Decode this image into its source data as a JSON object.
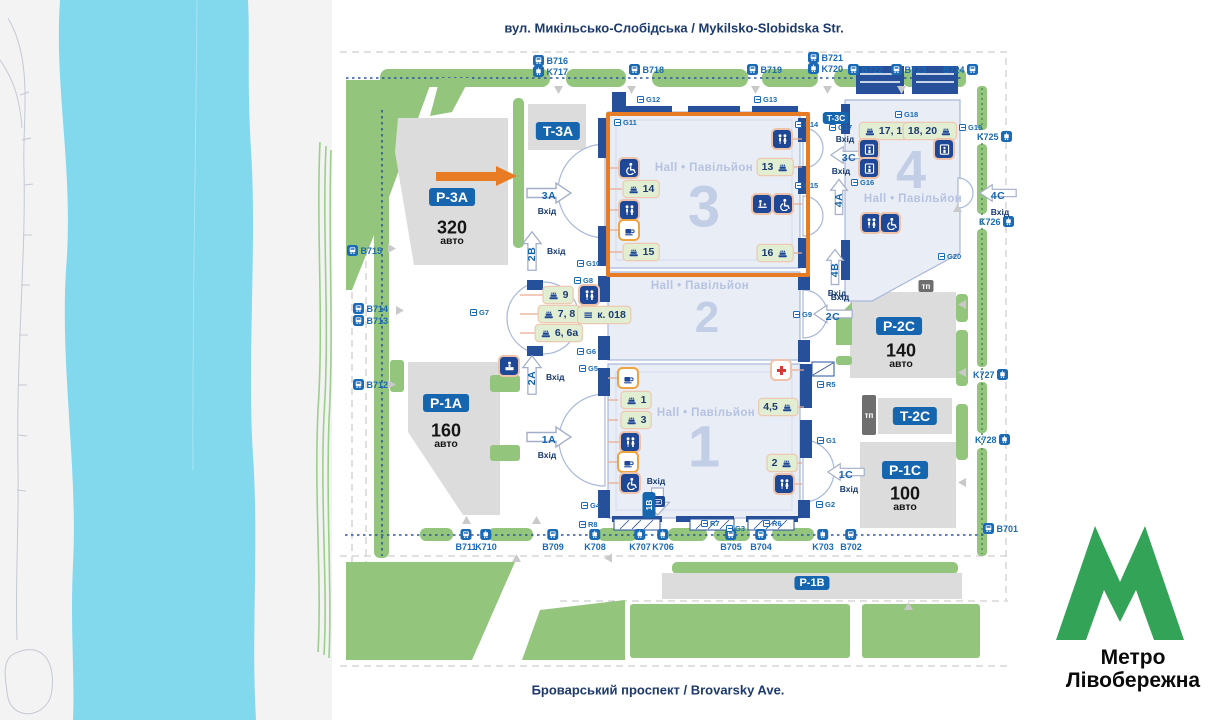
{
  "streets": {
    "top": "вул. Микільсько-Слобідська / Mykilsko-Slobidska Str.",
    "bottom": "Броварський проспект / Brovarsky Ave."
  },
  "metro": {
    "line1": "Метро",
    "line2": "Лівобережна"
  },
  "labels": {
    "entrance": "Вхід",
    "hall": "Hall • Павільйон",
    "cars": "авто",
    "tp": "тп"
  },
  "halls": {
    "h1": "1",
    "h2": "2",
    "h3": "3",
    "h4": "4"
  },
  "parking": {
    "p3a": {
      "code": "P-3A",
      "cars": "320"
    },
    "p1a": {
      "code": "P-1A",
      "cars": "160"
    },
    "p2c": {
      "code": "P-2C",
      "cars": "140"
    },
    "p1c": {
      "code": "P-1C",
      "cars": "100"
    },
    "p1b": {
      "code": "P-1B"
    },
    "t3a": "T-3A",
    "t2c": "T-2C",
    "t3c": "T-3C"
  },
  "entrances": {
    "e3a": "3A",
    "e2b": "2B",
    "e2a": "2A",
    "e1a": "1A",
    "e1b": "1B",
    "e2c": "2C",
    "e1c": "1C",
    "e3c": "3C",
    "e4a": "4A",
    "e4b": "4B",
    "e4c": "4C"
  },
  "rooms": {
    "r14": "14",
    "r15": "15",
    "r13": "13",
    "r16": "16",
    "r9": "9",
    "r78": "7, 8",
    "r66a": "6, 6а",
    "k018": "к. 018",
    "r1": "1",
    "r3": "3",
    "r45": "4,5",
    "r2": "2",
    "r1719": "17, 19",
    "r1820": "18, 20"
  },
  "stops": {
    "b716": "B716",
    "k717": "K717",
    "b718": "B718",
    "b719": "B719",
    "b721": "B721",
    "k720": "K720",
    "b722": "B722",
    "b723": "B723",
    "b724": "B724",
    "k725": "K725",
    "k726": "K726",
    "k727": "K727",
    "k728": "K728",
    "b701": "B701",
    "b702": "B702",
    "k703": "K703",
    "b704": "B704",
    "b705": "B705",
    "k706": "K706",
    "k707": "K707",
    "k708": "K708",
    "b709": "B709",
    "k710": "K710",
    "b711": "B711",
    "b712": "B712",
    "b713": "B713",
    "b714": "B714",
    "b715": "B715"
  },
  "gates": {
    "g1": "G1",
    "g2": "G2",
    "g3": "G3",
    "g4": "G4",
    "g5": "G5",
    "g6": "G6",
    "g7": "G7",
    "g8": "G8",
    "g9": "G9",
    "g10": "G10",
    "g11": "G11",
    "g12": "G12",
    "g13": "G13",
    "g14": "G14",
    "g15": "G15",
    "g16": "G16",
    "g17": "G17",
    "g18": "G18",
    "g19": "G19",
    "g20": "G20",
    "r5": "R5",
    "r6": "R6",
    "r7": "R7",
    "r8": "R8"
  },
  "colors": {
    "highlight": "#E87C25",
    "metro_green": "#33A357",
    "navy": "#1E4796",
    "water": "#81D8EC",
    "vegetation": "#93C57D"
  }
}
